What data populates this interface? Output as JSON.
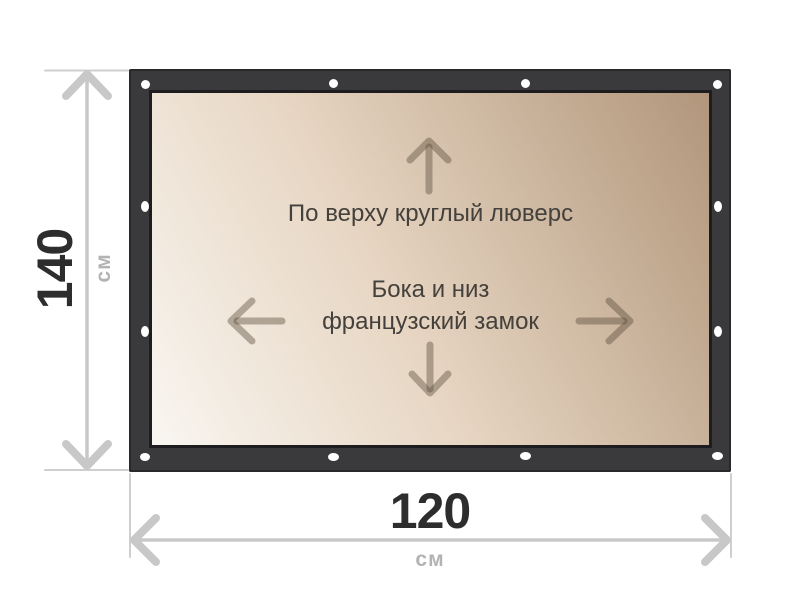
{
  "banner": {
    "frame_color": "#3a3a3c",
    "canvas_gradient": [
      "#f9f6f1",
      "#e7d6c3",
      "#b1967b"
    ],
    "grommet_color": "#ffffff",
    "notes": {
      "top": "По верху круглый люверс",
      "center_line1": "Бока и низ",
      "center_line2": "французский замок"
    },
    "arrow_icons": [
      "up-arrow-icon",
      "left-arrow-icon",
      "right-arrow-icon",
      "down-arrow-icon"
    ],
    "arrow_color": "rgba(88,74,58,0.42)",
    "grommets": [
      {
        "x": 145,
        "y": 84,
        "w": 9,
        "h": 9
      },
      {
        "x": 333,
        "y": 83,
        "w": 9,
        "h": 9
      },
      {
        "x": 525,
        "y": 83,
        "w": 9,
        "h": 9
      },
      {
        "x": 717,
        "y": 84,
        "w": 9,
        "h": 9
      },
      {
        "x": 145,
        "y": 206,
        "w": 8,
        "h": 11
      },
      {
        "x": 145,
        "y": 331,
        "w": 8,
        "h": 11
      },
      {
        "x": 718,
        "y": 206,
        "w": 8,
        "h": 11
      },
      {
        "x": 718,
        "y": 331,
        "w": 8,
        "h": 11
      },
      {
        "x": 145,
        "y": 457,
        "w": 10,
        "h": 8
      },
      {
        "x": 333,
        "y": 457,
        "w": 11,
        "h": 8
      },
      {
        "x": 525,
        "y": 456,
        "w": 11,
        "h": 8
      },
      {
        "x": 717,
        "y": 456,
        "w": 11,
        "h": 8
      }
    ]
  },
  "dimensions": {
    "height": {
      "value": "140",
      "unit": "см"
    },
    "width": {
      "value": "120",
      "unit": "см"
    },
    "line_color": "#c8c8c8",
    "tick_color": "#cfcfcf",
    "value_color": "#2d2d2d",
    "unit_color": "#b3b3b3"
  }
}
